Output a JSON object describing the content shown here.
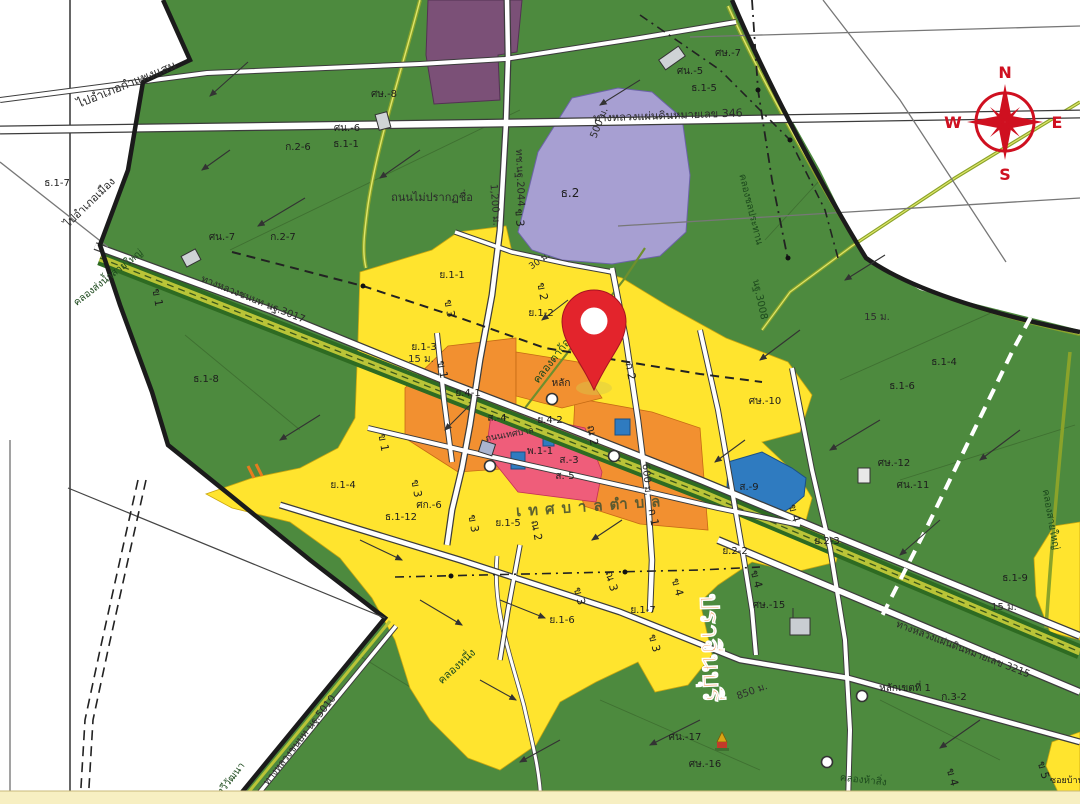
{
  "map": {
    "compass": {
      "n": "N",
      "e": "E",
      "s": "S",
      "w": "W"
    },
    "colors": {
      "agricultural_green": "#4d8a3e",
      "residential_yellow": "#ffe42e",
      "commercial_orange": "#f29030",
      "high_density_pink": "#ef5d7a",
      "institution_blue": "#2f7bc0",
      "religious_purple_dark": "#7b5077",
      "education_lavender": "#a79fd2",
      "canal_olive": "#b9c437",
      "pin_red": "#e3242c",
      "compass_red": "#cf1020",
      "road_white": "#ffffff"
    },
    "pin": {
      "present": true,
      "description": "red location marker"
    },
    "labels": [
      {
        "t": "ไปอำเภอกำแพงแสน",
        "x": 128,
        "y": 88,
        "r": -22,
        "s": 12,
        "c": "road"
      },
      {
        "t": "ไปอำเภอเมือง",
        "x": 92,
        "y": 205,
        "r": -44,
        "s": 11,
        "c": "road"
      },
      {
        "t": "ทางหลวงแผ่นดินหมายเลข 346",
        "x": 668,
        "y": 119,
        "r": -2,
        "s": 11,
        "c": "road"
      },
      {
        "t": "ทช.นฐ.2044",
        "x": 517,
        "y": 178,
        "r": 88,
        "s": 10,
        "c": "road"
      },
      {
        "t": "1,200 ม.",
        "x": 492,
        "y": 205,
        "r": 86,
        "s": 10,
        "c": "dim"
      },
      {
        "t": "ถนนไม่ปรากฏชื่อ",
        "x": 432,
        "y": 201,
        "r": 0,
        "s": 11,
        "c": "road"
      },
      {
        "t": "ศษ.-8",
        "x": 384,
        "y": 97,
        "r": 0,
        "s": 10,
        "c": "z"
      },
      {
        "t": "ศน.-6",
        "x": 347,
        "y": 131,
        "r": 0,
        "s": 10,
        "c": "z"
      },
      {
        "t": "ก.2-6",
        "x": 298,
        "y": 150,
        "r": 0,
        "s": 10,
        "c": "z"
      },
      {
        "t": "ธ.1-1",
        "x": 346,
        "y": 147,
        "r": 0,
        "s": 10,
        "c": "z"
      },
      {
        "t": "ธ.1-7",
        "x": 57,
        "y": 186,
        "r": 0,
        "s": 10,
        "c": "z"
      },
      {
        "t": "ศน.-7",
        "x": 222,
        "y": 240,
        "r": 0,
        "s": 10,
        "c": "z"
      },
      {
        "t": "ก.2-7",
        "x": 283,
        "y": 240,
        "r": 0,
        "s": 10,
        "c": "z"
      },
      {
        "t": "ศษ.-7",
        "x": 728,
        "y": 56,
        "r": 0,
        "s": 10,
        "c": "z"
      },
      {
        "t": "ศน.-5",
        "x": 690,
        "y": 74,
        "r": 0,
        "s": 10,
        "c": "z"
      },
      {
        "t": "ธ.1-5",
        "x": 704,
        "y": 91,
        "r": 0,
        "s": 10,
        "c": "z"
      },
      {
        "t": "ธ.2",
        "x": 570,
        "y": 197,
        "r": 0,
        "s": 12,
        "c": "z"
      },
      {
        "t": "500 ม.",
        "x": 602,
        "y": 124,
        "r": -68,
        "s": 10,
        "c": "dim"
      },
      {
        "t": "คลองชลประทาน",
        "x": 748,
        "y": 210,
        "r": 76,
        "s": 10,
        "c": "canal"
      },
      {
        "t": "นฐ.3008",
        "x": 757,
        "y": 300,
        "r": 78,
        "s": 10,
        "c": "canal"
      },
      {
        "t": "15 ม.",
        "x": 877,
        "y": 320,
        "r": 0,
        "s": 10,
        "c": "dim"
      },
      {
        "t": "ธ.1-4",
        "x": 944,
        "y": 365,
        "r": 0,
        "s": 10,
        "c": "z"
      },
      {
        "t": "ธ.1-6",
        "x": 902,
        "y": 389,
        "r": 0,
        "s": 10,
        "c": "z"
      },
      {
        "t": "ศษ.-10",
        "x": 765,
        "y": 404,
        "r": 0,
        "s": 10,
        "c": "z"
      },
      {
        "t": "ศษ.-12",
        "x": 894,
        "y": 466,
        "r": 0,
        "s": 10,
        "c": "z"
      },
      {
        "t": "ศน.-11",
        "x": 913,
        "y": 488,
        "r": 0,
        "s": 10,
        "c": "z"
      },
      {
        "t": "ธ.1-9",
        "x": 1015,
        "y": 581,
        "r": 0,
        "s": 10,
        "c": "z"
      },
      {
        "t": "15 ม.",
        "x": 1004,
        "y": 610,
        "r": 0,
        "s": 10,
        "c": "dim"
      },
      {
        "t": "คลองสายใหญ่",
        "x": 1048,
        "y": 520,
        "r": 80,
        "s": 10,
        "c": "canal"
      },
      {
        "t": "คลองส่งน้ำสายใหญ่",
        "x": 110,
        "y": 280,
        "r": -38,
        "s": 10,
        "c": "canal"
      },
      {
        "t": "ทางหลวงชนบท นฐ.3017",
        "x": 252,
        "y": 302,
        "r": 22,
        "s": 10,
        "c": "road"
      },
      {
        "t": "ธ.1-8",
        "x": 206,
        "y": 382,
        "r": 0,
        "s": 10,
        "c": "z"
      },
      {
        "t": "ข 1",
        "x": 154,
        "y": 298,
        "r": 80,
        "s": 11,
        "c": "z"
      },
      {
        "t": "ย.1-1",
        "x": 452,
        "y": 278,
        "r": 0,
        "s": 10,
        "c": "z"
      },
      {
        "t": "ข 2",
        "x": 539,
        "y": 292,
        "r": 80,
        "s": 11,
        "c": "z"
      },
      {
        "t": "ข 3",
        "x": 446,
        "y": 309,
        "r": 80,
        "s": 11,
        "c": "z"
      },
      {
        "t": "ข 3",
        "x": 516,
        "y": 218,
        "r": 85,
        "s": 11,
        "c": "z"
      },
      {
        "t": "ย.1-2",
        "x": 541,
        "y": 316,
        "r": 0,
        "s": 10,
        "c": "z"
      },
      {
        "t": "คลองตาก้อง",
        "x": 556,
        "y": 361,
        "r": -52,
        "s": 11,
        "c": "canal"
      },
      {
        "t": "หลัก",
        "x": 561,
        "y": 386,
        "r": 0,
        "s": 10,
        "c": "z"
      },
      {
        "t": "ก 2",
        "x": 627,
        "y": 372,
        "r": 80,
        "s": 11,
        "c": "z"
      },
      {
        "t": "30 ม.",
        "x": 541,
        "y": 263,
        "r": -35,
        "s": 9,
        "c": "dim"
      },
      {
        "t": "ย.1-3",
        "x": 424,
        "y": 350,
        "r": 0,
        "s": 10,
        "c": "z"
      },
      {
        "t": "15 ม.",
        "x": 421,
        "y": 362,
        "r": 0,
        "s": 10,
        "c": "dim"
      },
      {
        "t": "ข 1",
        "x": 439,
        "y": 370,
        "r": 80,
        "s": 11,
        "c": "z"
      },
      {
        "t": "ย.4-1",
        "x": 468,
        "y": 396,
        "r": 0,
        "s": 10,
        "c": "z"
      },
      {
        "t": "ส.-4",
        "x": 497,
        "y": 421,
        "r": 0,
        "s": 10,
        "c": "z"
      },
      {
        "t": "ย.4-2",
        "x": 550,
        "y": 423,
        "r": 0,
        "s": 10,
        "c": "z"
      },
      {
        "t": "ถนนเทศบาล",
        "x": 510,
        "y": 437,
        "r": -10,
        "s": 9,
        "c": "road"
      },
      {
        "t": "พ.1-1",
        "x": 540,
        "y": 454,
        "r": 0,
        "s": 10,
        "c": "z"
      },
      {
        "t": "ส.-3",
        "x": 569,
        "y": 463,
        "r": 0,
        "s": 10,
        "c": "z"
      },
      {
        "t": "ส.-5",
        "x": 565,
        "y": 479,
        "r": 0,
        "s": 10,
        "c": "z"
      },
      {
        "t": "ณ 2",
        "x": 589,
        "y": 436,
        "r": 80,
        "s": 11,
        "c": "z"
      },
      {
        "t": "600 ม.",
        "x": 644,
        "y": 480,
        "r": 85,
        "s": 10,
        "c": "dim"
      },
      {
        "t": "ข 1",
        "x": 380,
        "y": 443,
        "r": 80,
        "s": 11,
        "c": "z"
      },
      {
        "t": "ย.1-4",
        "x": 343,
        "y": 488,
        "r": 0,
        "s": 10,
        "c": "z"
      },
      {
        "t": "ข 3",
        "x": 413,
        "y": 489,
        "r": 80,
        "s": 11,
        "c": "z"
      },
      {
        "t": "ศก.-6",
        "x": 429,
        "y": 508,
        "r": 0,
        "s": 10,
        "c": "z"
      },
      {
        "t": "ธ.1-12",
        "x": 401,
        "y": 520,
        "r": 0,
        "s": 10,
        "c": "z"
      },
      {
        "t": "ข 3",
        "x": 470,
        "y": 524,
        "r": 80,
        "s": 11,
        "c": "z"
      },
      {
        "t": "ย.1-5",
        "x": 508,
        "y": 526,
        "r": 0,
        "s": 10,
        "c": "z"
      },
      {
        "t": "เทศบาลตำบล",
        "x": 592,
        "y": 511,
        "r": -4,
        "s": 15,
        "c": "muni"
      },
      {
        "t": "ณ 2",
        "x": 533,
        "y": 531,
        "r": 80,
        "s": 11,
        "c": "z"
      },
      {
        "t": "ก 1",
        "x": 650,
        "y": 518,
        "r": 80,
        "s": 11,
        "c": "z"
      },
      {
        "t": "ข 3",
        "x": 576,
        "y": 597,
        "r": 75,
        "s": 11,
        "c": "z"
      },
      {
        "t": "ณ 3",
        "x": 608,
        "y": 582,
        "r": 75,
        "s": 11,
        "c": "z"
      },
      {
        "t": "ย.1-6",
        "x": 562,
        "y": 623,
        "r": 0,
        "s": 10,
        "c": "z"
      },
      {
        "t": "ย.1-7",
        "x": 643,
        "y": 613,
        "r": 0,
        "s": 10,
        "c": "z"
      },
      {
        "t": "ข 3",
        "x": 651,
        "y": 644,
        "r": 75,
        "s": 11,
        "c": "z"
      },
      {
        "t": "ข 4",
        "x": 674,
        "y": 588,
        "r": 75,
        "s": 11,
        "c": "z"
      },
      {
        "t": "คลองหนึ่ง",
        "x": 459,
        "y": 669,
        "r": -42,
        "s": 11,
        "c": "canal"
      },
      {
        "t": "ศน.-17",
        "x": 685,
        "y": 740,
        "r": 0,
        "s": 10,
        "c": "z"
      },
      {
        "t": "ศษ.-16",
        "x": 705,
        "y": 767,
        "r": 0,
        "s": 10,
        "c": "z"
      },
      {
        "t": "ย.2-2",
        "x": 735,
        "y": 554,
        "r": 0,
        "s": 10,
        "c": "z"
      },
      {
        "t": "ย.2-3",
        "x": 827,
        "y": 544,
        "r": 0,
        "s": 10,
        "c": "z"
      },
      {
        "t": "ข 4",
        "x": 791,
        "y": 514,
        "r": 75,
        "s": 11,
        "c": "z"
      },
      {
        "t": "ข 4",
        "x": 753,
        "y": 580,
        "r": 75,
        "s": 11,
        "c": "z"
      },
      {
        "t": "ส.-9",
        "x": 749,
        "y": 490,
        "r": 0,
        "s": 10,
        "c": "z"
      },
      {
        "t": "ศษ.-15",
        "x": 769,
        "y": 608,
        "r": 0,
        "s": 10,
        "c": "z"
      },
      {
        "t": "850 ม.",
        "x": 753,
        "y": 694,
        "r": -20,
        "s": 10,
        "c": "dim"
      },
      {
        "t": "หลักเขตที่ 1",
        "x": 905,
        "y": 691,
        "r": 0,
        "s": 10,
        "c": "z"
      },
      {
        "t": "ก.3-2",
        "x": 954,
        "y": 700,
        "r": 0,
        "s": 10,
        "c": "z"
      },
      {
        "t": "ทางหลวงแผ่นดินหมายเลข 3215",
        "x": 962,
        "y": 652,
        "r": 21,
        "s": 10,
        "c": "road"
      },
      {
        "t": "ข 4",
        "x": 949,
        "y": 778,
        "r": 75,
        "s": 11,
        "c": "z"
      },
      {
        "t": "ข 5",
        "x": 1040,
        "y": 771,
        "r": 75,
        "s": 11,
        "c": "z"
      },
      {
        "t": "ซอยบ้านใหม่",
        "x": 1075,
        "y": 783,
        "r": 0,
        "s": 9,
        "c": "z"
      },
      {
        "t": "คลองห้าสิ่ง",
        "x": 863,
        "y": 783,
        "r": 6,
        "s": 10,
        "c": "canal"
      },
      {
        "t": "ทวีวัฒนา",
        "x": 233,
        "y": 781,
        "r": -52,
        "s": 10,
        "c": "canal"
      },
      {
        "t": "ทางหลวงชนบท นฐ.5010",
        "x": 302,
        "y": 742,
        "r": -52,
        "s": 10,
        "c": "road"
      },
      {
        "t": "ปราจีนบุรี",
        "x": 702,
        "y": 648,
        "r": 88,
        "s": 26,
        "c": "bigorange"
      }
    ]
  }
}
